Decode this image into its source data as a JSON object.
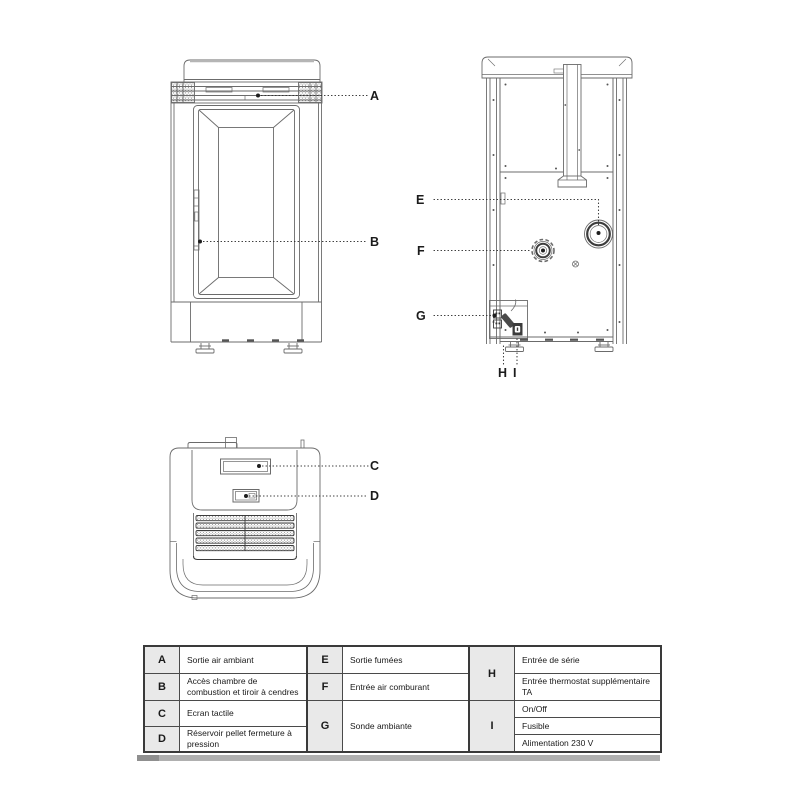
{
  "colors": {
    "line": "#6b6b6b",
    "dark_line": "#3c3c3c",
    "label_text": "#1b1b1b",
    "table_border": "#3a3a3a",
    "letter_cell_bg": "#e9e9e9",
    "shadow_bar": "#b0b0b0"
  },
  "callouts": {
    "a": "A",
    "b": "B",
    "c": "C",
    "d": "D",
    "e": "E",
    "f": "F",
    "g": "G",
    "h": "H",
    "i": "I"
  },
  "legend": {
    "sections": [
      {
        "rows": [
          {
            "key": "A",
            "label": "Sortie air ambiant"
          },
          {
            "key": "B",
            "label": "Accès chambre de combustion et tiroir à cendres"
          },
          {
            "key": "C",
            "label": "Ecran tactile"
          },
          {
            "key": "D",
            "label": "Réservoir pellet fermeture à pression"
          }
        ]
      },
      {
        "rows": [
          {
            "key": "E",
            "label": "Sortie fumées"
          },
          {
            "key": "F",
            "label": "Entrée air comburant"
          },
          {
            "key": "G",
            "label": "Sonde ambiante"
          }
        ]
      },
      {
        "rows": [
          {
            "key": "H",
            "labels": [
              "Entrée de série",
              "Entrée thermostat supplémentaire TA"
            ]
          },
          {
            "key": "I",
            "labels": [
              "On/Off",
              "Fusible",
              "Alimentation 230 V"
            ]
          }
        ]
      }
    ]
  }
}
